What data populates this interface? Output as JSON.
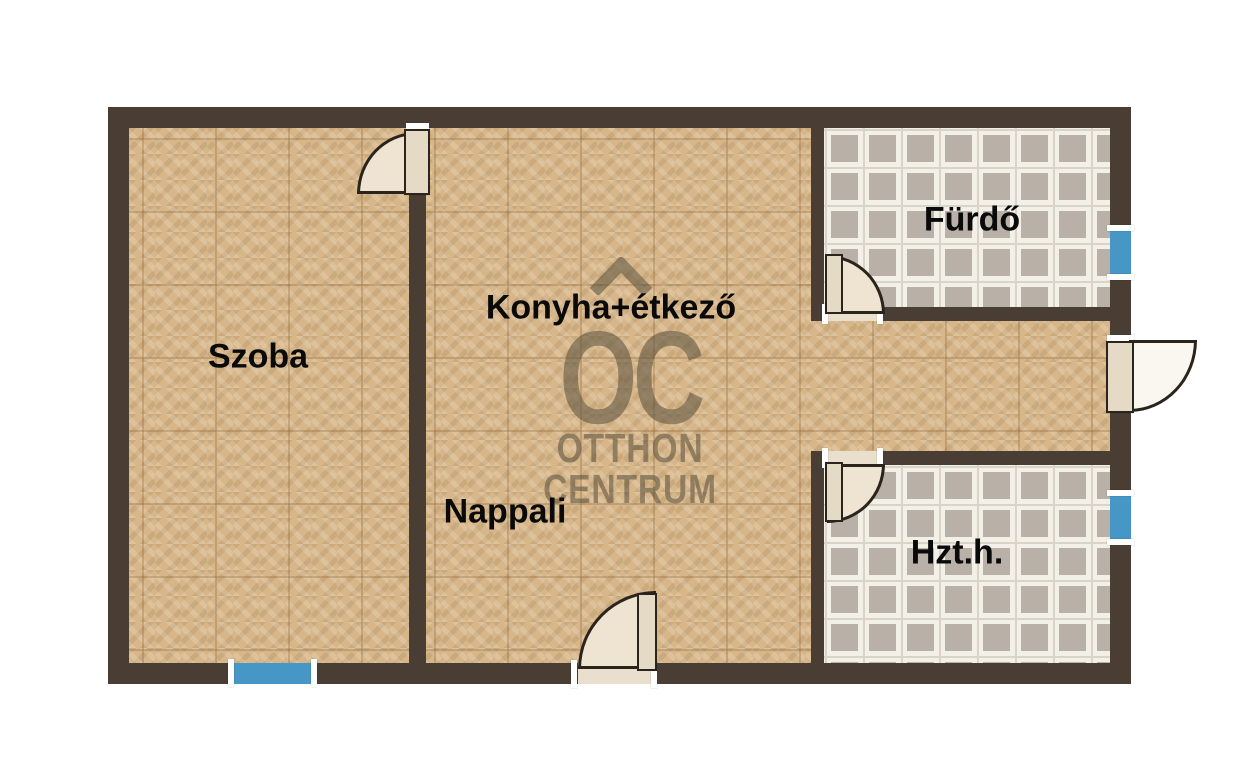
{
  "rooms": {
    "szoba": {
      "label": "Szoba"
    },
    "konyha": {
      "label": "Konyha+étkező"
    },
    "nappali": {
      "label": "Nappali"
    },
    "furdo": {
      "label": "Fürdő"
    },
    "hzth": {
      "label": "Hzt.h."
    }
  },
  "watermark": {
    "oc": "OC",
    "line1": "OTTHON",
    "line2": "CENTRUM"
  },
  "colors": {
    "wall": "#4a3e34",
    "parquet_floor": "#d7b78a",
    "tile_floor_light": "#f3f0e8",
    "tile_floor_accent": "#b9b0a7",
    "window_blue": "#4697c6",
    "door_fill": "#eee4d1",
    "watermark_gray": "#58503d"
  }
}
